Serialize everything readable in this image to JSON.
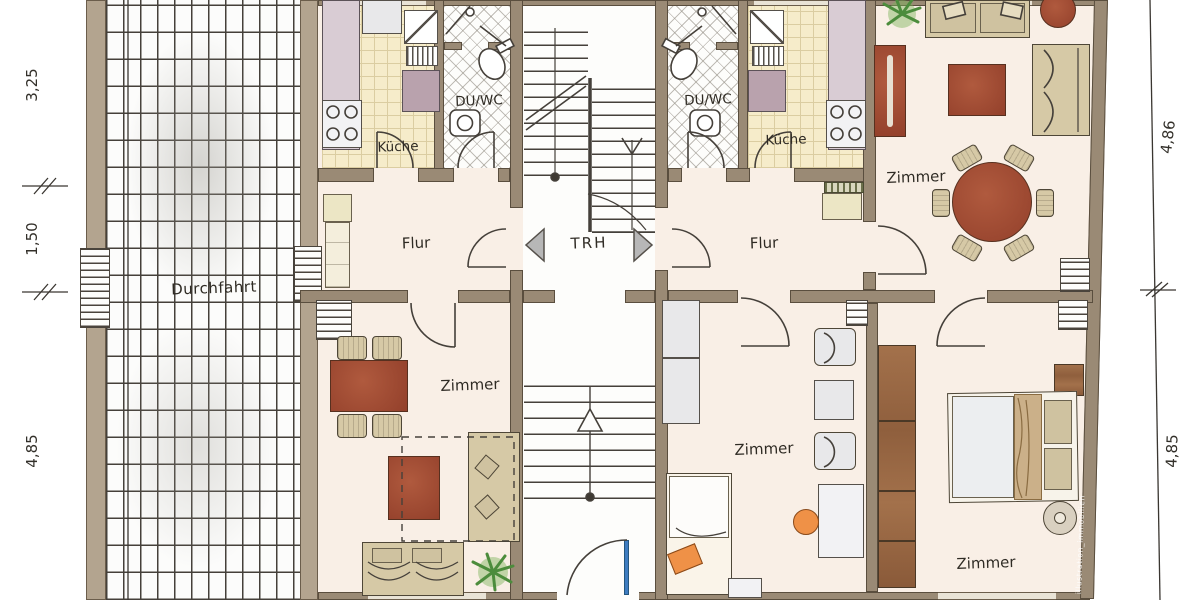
{
  "plan": {
    "rooms": {
      "durchfahrt": "Durchfahrt",
      "trh": "TRH",
      "flur_left": "Flur",
      "flur_right": "Flur",
      "kueche_left": "Küche",
      "kueche_right": "Küche",
      "du_wc_left": "DU/WC",
      "du_wc_right": "DU/WC",
      "zimmer_top_right": "Zimmer",
      "zimmer_bottom_left": "Zimmer",
      "zimmer_bottom_middle": "Zimmer",
      "zimmer_bottom_right": "Zimmer"
    },
    "dimensions": {
      "left": [
        "3,25",
        "1,50",
        "4,85"
      ],
      "right": [
        "4,86",
        "4,85"
      ]
    },
    "watermark": "illustration_immobilien",
    "colors": {
      "wall": "#9a8a75",
      "floor": "#f9efe6",
      "kitchen_tile": "#f6ecca",
      "furniture_red": "#a34a31",
      "furniture_beige": "#d6c9a6",
      "wardrobe_brown": "#9c6c49",
      "accent_orange": "#ef9147",
      "entry_door_blue": "#3e7cc0",
      "plant_green": "#4c8c3c"
    }
  }
}
